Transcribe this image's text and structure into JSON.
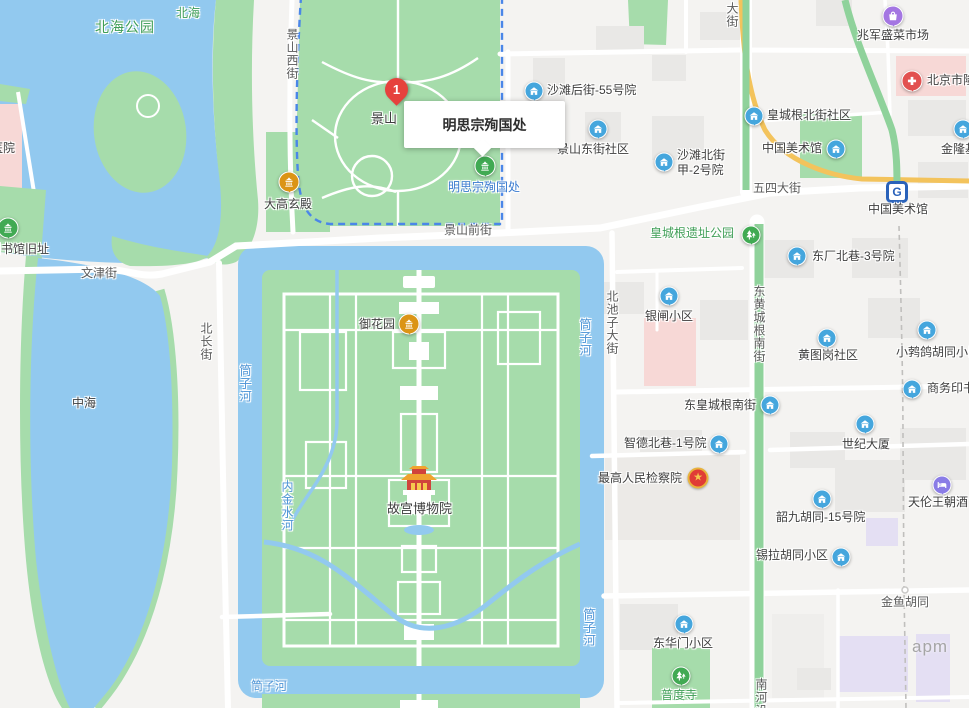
{
  "selected_place": {
    "marker_number": "1",
    "tooltip_title": "明思宗殉国处",
    "poi_label": "明思宗殉国处"
  },
  "streets": {
    "jingshan_west": "景山西街",
    "wenjin": "文津街",
    "beichang": "北长街",
    "jingshan_front": "景山前街",
    "wusi": "五四大街",
    "beichizi": "北池子大街",
    "donghuang_south": "东黄城根南街",
    "jinyu": "金鱼胡同",
    "nanheyan": "南河沿",
    "dajie": "大街"
  },
  "waters": {
    "beihai": "北海",
    "zhonghai": "中海",
    "tongzi": "筒子河",
    "neijinshui": "内金水河"
  },
  "parks": {
    "beihai_park": "北海公园",
    "huangchenggen_park": "皇城根遗址公园",
    "jingshan": "景山"
  },
  "pois": {
    "hospital_edge": "医院",
    "library_site": "图书馆旧址",
    "dagaoxuan": "大高玄殿",
    "yuhuayuan": "御花园",
    "gugong": "故宫博物院",
    "shatan55": "沙滩后街-55号院",
    "jingshan_east_comm": "景山东街社区",
    "shatan_north_l1": "沙滩北街",
    "shatan_north_l2": "甲-2号院",
    "dongchang3": "东厂北巷-3号院",
    "art_museum": "中国美术馆",
    "art_museum_station": "中国美术馆",
    "jinlongji": "金隆基",
    "zhaojun_market": "兆军盛菜市场",
    "beijing_hospital": "北京市隆",
    "hcg_north_comm": "皇城根北街社区",
    "yinzha": "银闸小区",
    "huangtugang": "黄图岗社区",
    "xiaoboge": "小鹁鸽胡同小区",
    "shangwu": "商务印书",
    "dhcg_south": "东皇城根南街",
    "zhide1": "智德北巷-1号院",
    "procuratorate": "最高人民检察院",
    "century": "世纪大厦",
    "shaojiu15": "韶九胡同-15号院",
    "tianlun": "天伦王朝酒",
    "xila": "锡拉胡同小区",
    "apm": "apm",
    "donghuamen": "东华门小区",
    "pudu": "普度寺"
  },
  "icons": {
    "community-icon": "#45a6dd",
    "temple-amber-icon": "#db9416",
    "temple-green-icon": "#41aa53",
    "tree-icon": "#41aa53",
    "market-bag-icon": "#a476e2",
    "hospital-cross-icon": "#e25150",
    "hotel-bed-icon": "#8a7ce6",
    "subway-icon": "#2a62ba",
    "emblem-icon": "#e03c36",
    "marker-pin": "#e6413d"
  },
  "colors": {
    "land": "#f4f3f1",
    "water": "#92c9ef",
    "park_green": "#a6dcab",
    "green_band_road": "#8fd29b",
    "yellow_road": "#f3c35c",
    "building": "#e9e8e6",
    "building_pink": "#f7d8d6",
    "building_lavender": "#e4dff3",
    "selection_border": "#4a86e8"
  }
}
